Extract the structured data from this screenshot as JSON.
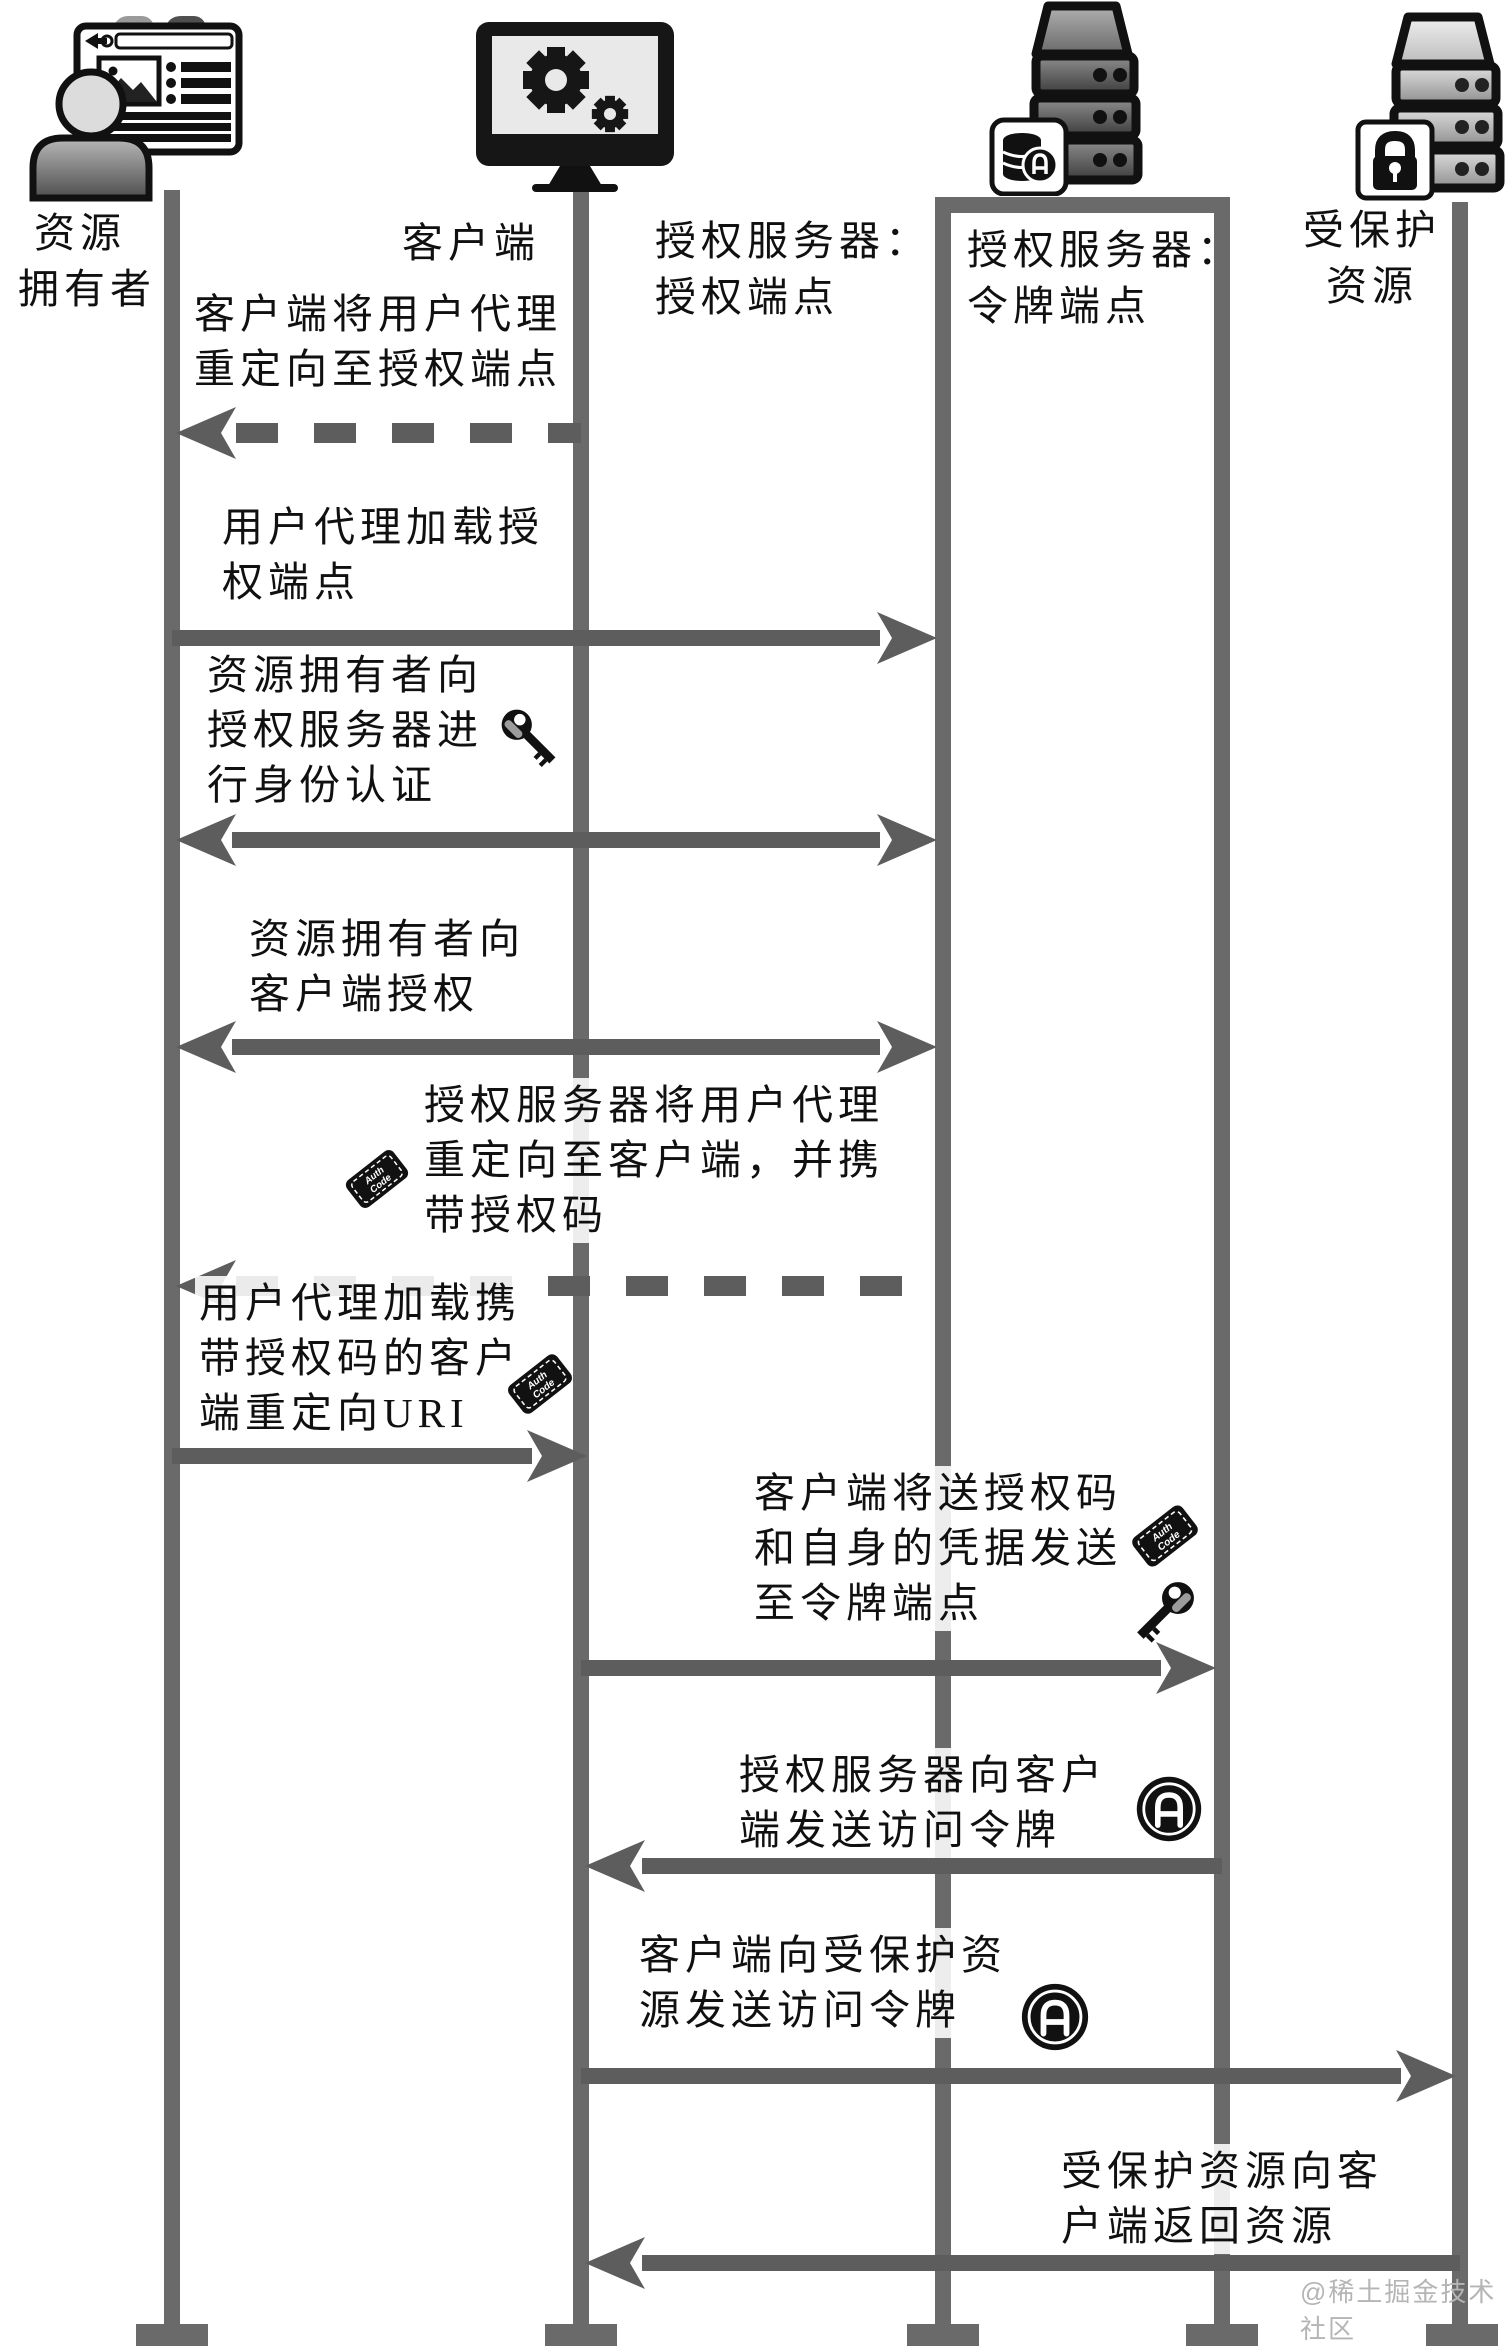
{
  "watermark": "@稀土掘金技术社区",
  "colors": {
    "lifeline": "#6a6a6a",
    "arrow": "#5d5d5d",
    "text": "#101010",
    "watermark": "#b5b5b5"
  },
  "icons": {
    "ticket_line1": "Auth",
    "ticket_line2": "Code",
    "names": [
      "user-browser-icon",
      "monitor-gears-icon",
      "server-database-icon",
      "server-lock-icon",
      "key-icon",
      "auth-code-ticket-icon",
      "access-token-icon"
    ]
  },
  "actors": [
    {
      "line1": "资源",
      "line2": "拥有者"
    },
    {
      "line1": "客户端"
    },
    {
      "line1": "授权服务器：",
      "line2": "授权端点"
    },
    {
      "line1": "授权服务器：",
      "line2": "令牌端点"
    },
    {
      "line1": "受保护",
      "line2": "资源"
    }
  ],
  "messages": [
    {
      "line1": "客户端将用户代理",
      "line2": "重定向至授权端点"
    },
    {
      "line1": "用户代理加载授",
      "line2": "权端点"
    },
    {
      "line1": "资源拥有者向",
      "line2": "授权服务器进",
      "line3": "行身份认证"
    },
    {
      "line1": "资源拥有者向",
      "line2": "客户端授权"
    },
    {
      "line1": "授权服务器将用户代理",
      "line2": "重定向至客户端，并携",
      "line3": "带授权码"
    },
    {
      "line1": "用户代理加载携",
      "line2": "带授权码的客户",
      "line3": "端重定向URI"
    },
    {
      "line1": "客户端将送授权码",
      "line2": "和自身的凭据发送",
      "line3": "至令牌端点"
    },
    {
      "line1": "授权服务器向客户",
      "line2": "端发送访问令牌"
    },
    {
      "line1": "客户端向受保护资",
      "line2": "源发送访问令牌"
    },
    {
      "line1": "受保护资源向客",
      "line2": "户端返回资源"
    }
  ]
}
